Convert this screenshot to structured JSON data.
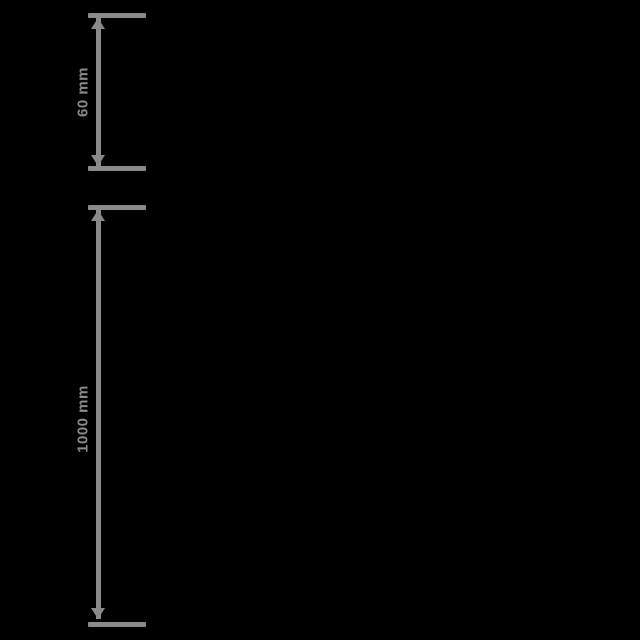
{
  "colors": {
    "background": "#000000",
    "line": "#8a8a8a"
  },
  "dimensions": {
    "top": {
      "label": "60 mm",
      "unit": "mm"
    },
    "bottom": {
      "label": "1000 mm",
      "unit": "mm"
    }
  }
}
